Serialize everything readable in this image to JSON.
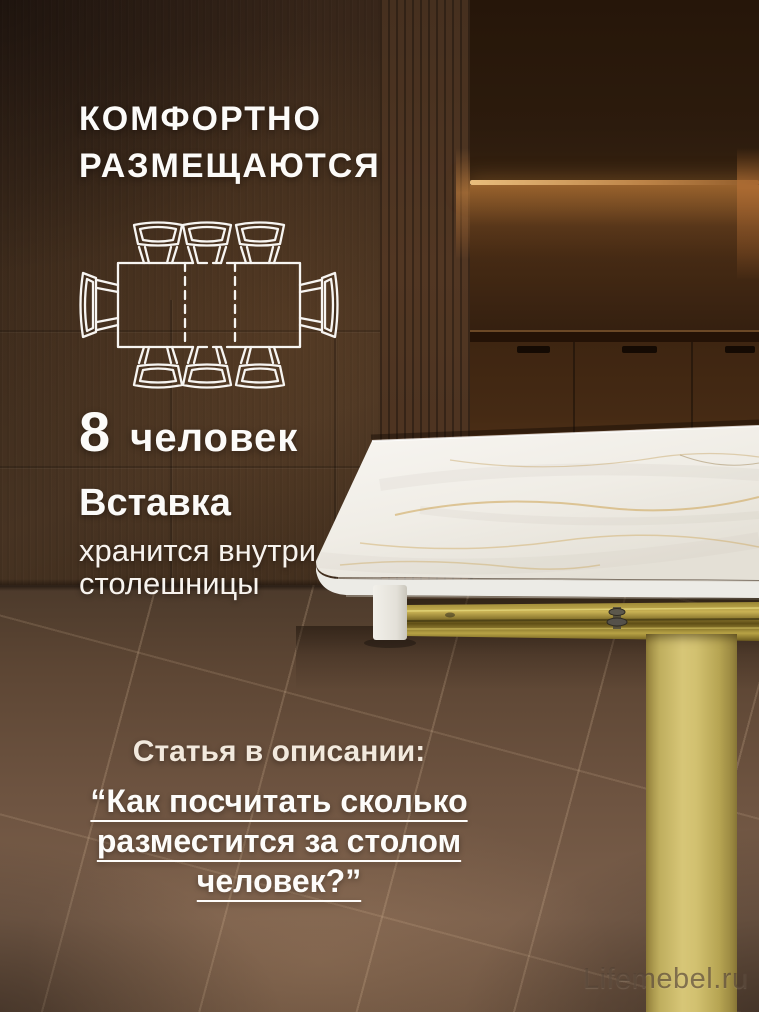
{
  "colors": {
    "background_brown": "#3a2a1c",
    "floor_brown": "#6e5442",
    "accent_gold": "#cdbb66",
    "marble_white": "#f2efe9",
    "light_strip": "#eec188",
    "text_primary": "#fcfbf9",
    "text_cream": "#f2e9dd",
    "diagram_stroke": "#f7f5f2"
  },
  "header": {
    "title_lines": [
      "КОМФОРТНО",
      "РАЗМЕЩАЮТСЯ"
    ]
  },
  "capacity": {
    "number": "8",
    "label": "человек"
  },
  "insert_note": {
    "title": "Вставка",
    "lines": [
      "хранится внутри",
      "столешницы"
    ]
  },
  "article": {
    "lead": "Статья в описании:",
    "quote_lines": [
      "“Как посчитать сколько",
      "разместится за столом",
      "человек?”"
    ]
  },
  "watermark": "Lifemebel.ru",
  "diagram": {
    "seats_total": 8,
    "seats_top": 3,
    "seats_bottom": 3,
    "seats_left": 1,
    "seats_right": 1
  }
}
